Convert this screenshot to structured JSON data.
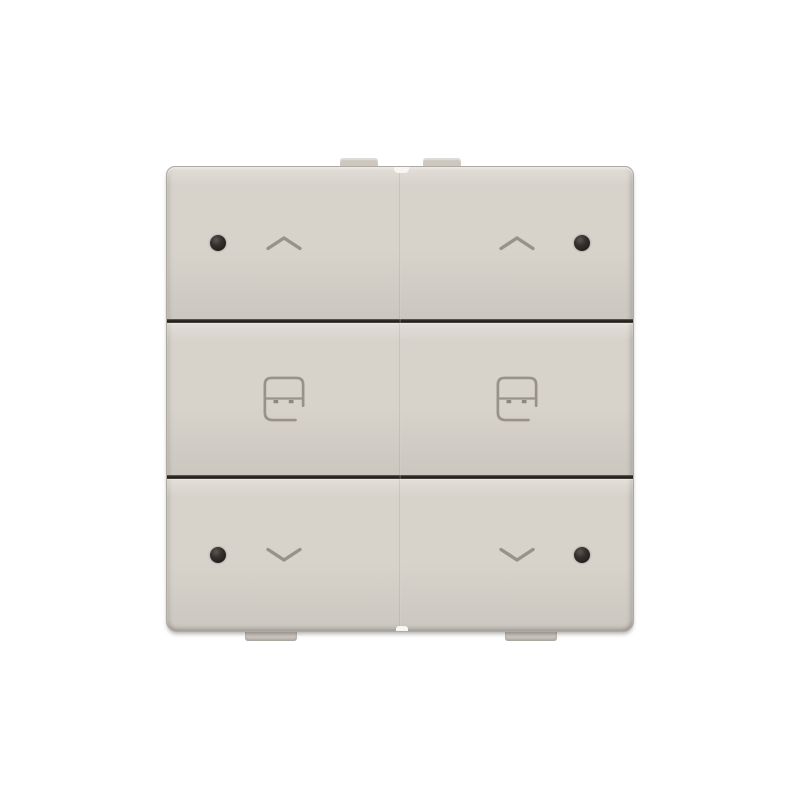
{
  "product": {
    "type": "double-sunblind-control-wall-switch",
    "panel_layout": "2 columns x 3 rows",
    "buttons": [
      {
        "id": "up-left",
        "action": "up",
        "icon": "chevron-up-icon",
        "led": true,
        "led_side": "left"
      },
      {
        "id": "up-right",
        "action": "up",
        "icon": "chevron-up-icon",
        "led": true,
        "led_side": "right"
      },
      {
        "id": "preset-left",
        "action": "preset",
        "icon": "sunblind-icon",
        "led": false
      },
      {
        "id": "preset-right",
        "action": "preset",
        "icon": "sunblind-icon",
        "led": false
      },
      {
        "id": "down-left",
        "action": "down",
        "icon": "chevron-down-icon",
        "led": true,
        "led_side": "left"
      },
      {
        "id": "down-right",
        "action": "down",
        "icon": "chevron-down-icon",
        "led": true,
        "led_side": "right"
      }
    ]
  },
  "colors": {
    "background": "#ffffff",
    "body": "#d7d2ca",
    "tab": "#ccc7bf",
    "divider": "#2b2823",
    "seam": "#c8c3bb",
    "icon": "#97928a",
    "icon_tab_fill": "#8d887f",
    "led": "#23211e",
    "led_hi": "#5a564f",
    "nub": "#f7f6f3"
  }
}
